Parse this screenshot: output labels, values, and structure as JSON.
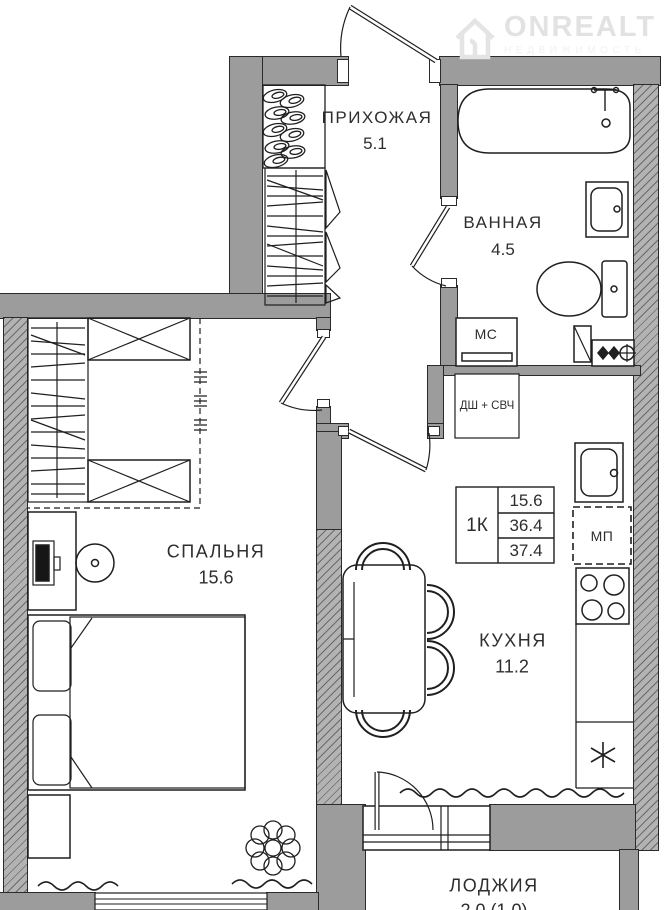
{
  "brand": {
    "name": "ONREALT",
    "tagline": "НЕДВИЖИМОСТЬ"
  },
  "rooms": {
    "hallway": {
      "name": "ПРИХОЖАЯ",
      "area": "5.1"
    },
    "bathroom": {
      "name": "ВАННАЯ",
      "area": "4.5"
    },
    "bedroom": {
      "name": "СПАЛЬНЯ",
      "area": "15.6"
    },
    "kitchen": {
      "name": "КУХНЯ",
      "area": "11.2"
    },
    "loggia": {
      "name": "ЛОДЖИЯ",
      "area": "2.0 (1.0)"
    }
  },
  "appliances": {
    "washing_machine": "МС",
    "dishwasher_microwave": "ДШ + СВЧ",
    "appliance_niche": "МП"
  },
  "summary": {
    "type": "1К",
    "rows": [
      "15.6",
      "36.4",
      "37.4"
    ]
  },
  "colors": {
    "wall": "#9c9c9c",
    "hatched_wall": "#b3b3b3",
    "line": "#1f1f1f",
    "watermark": "#e2e2e2"
  }
}
